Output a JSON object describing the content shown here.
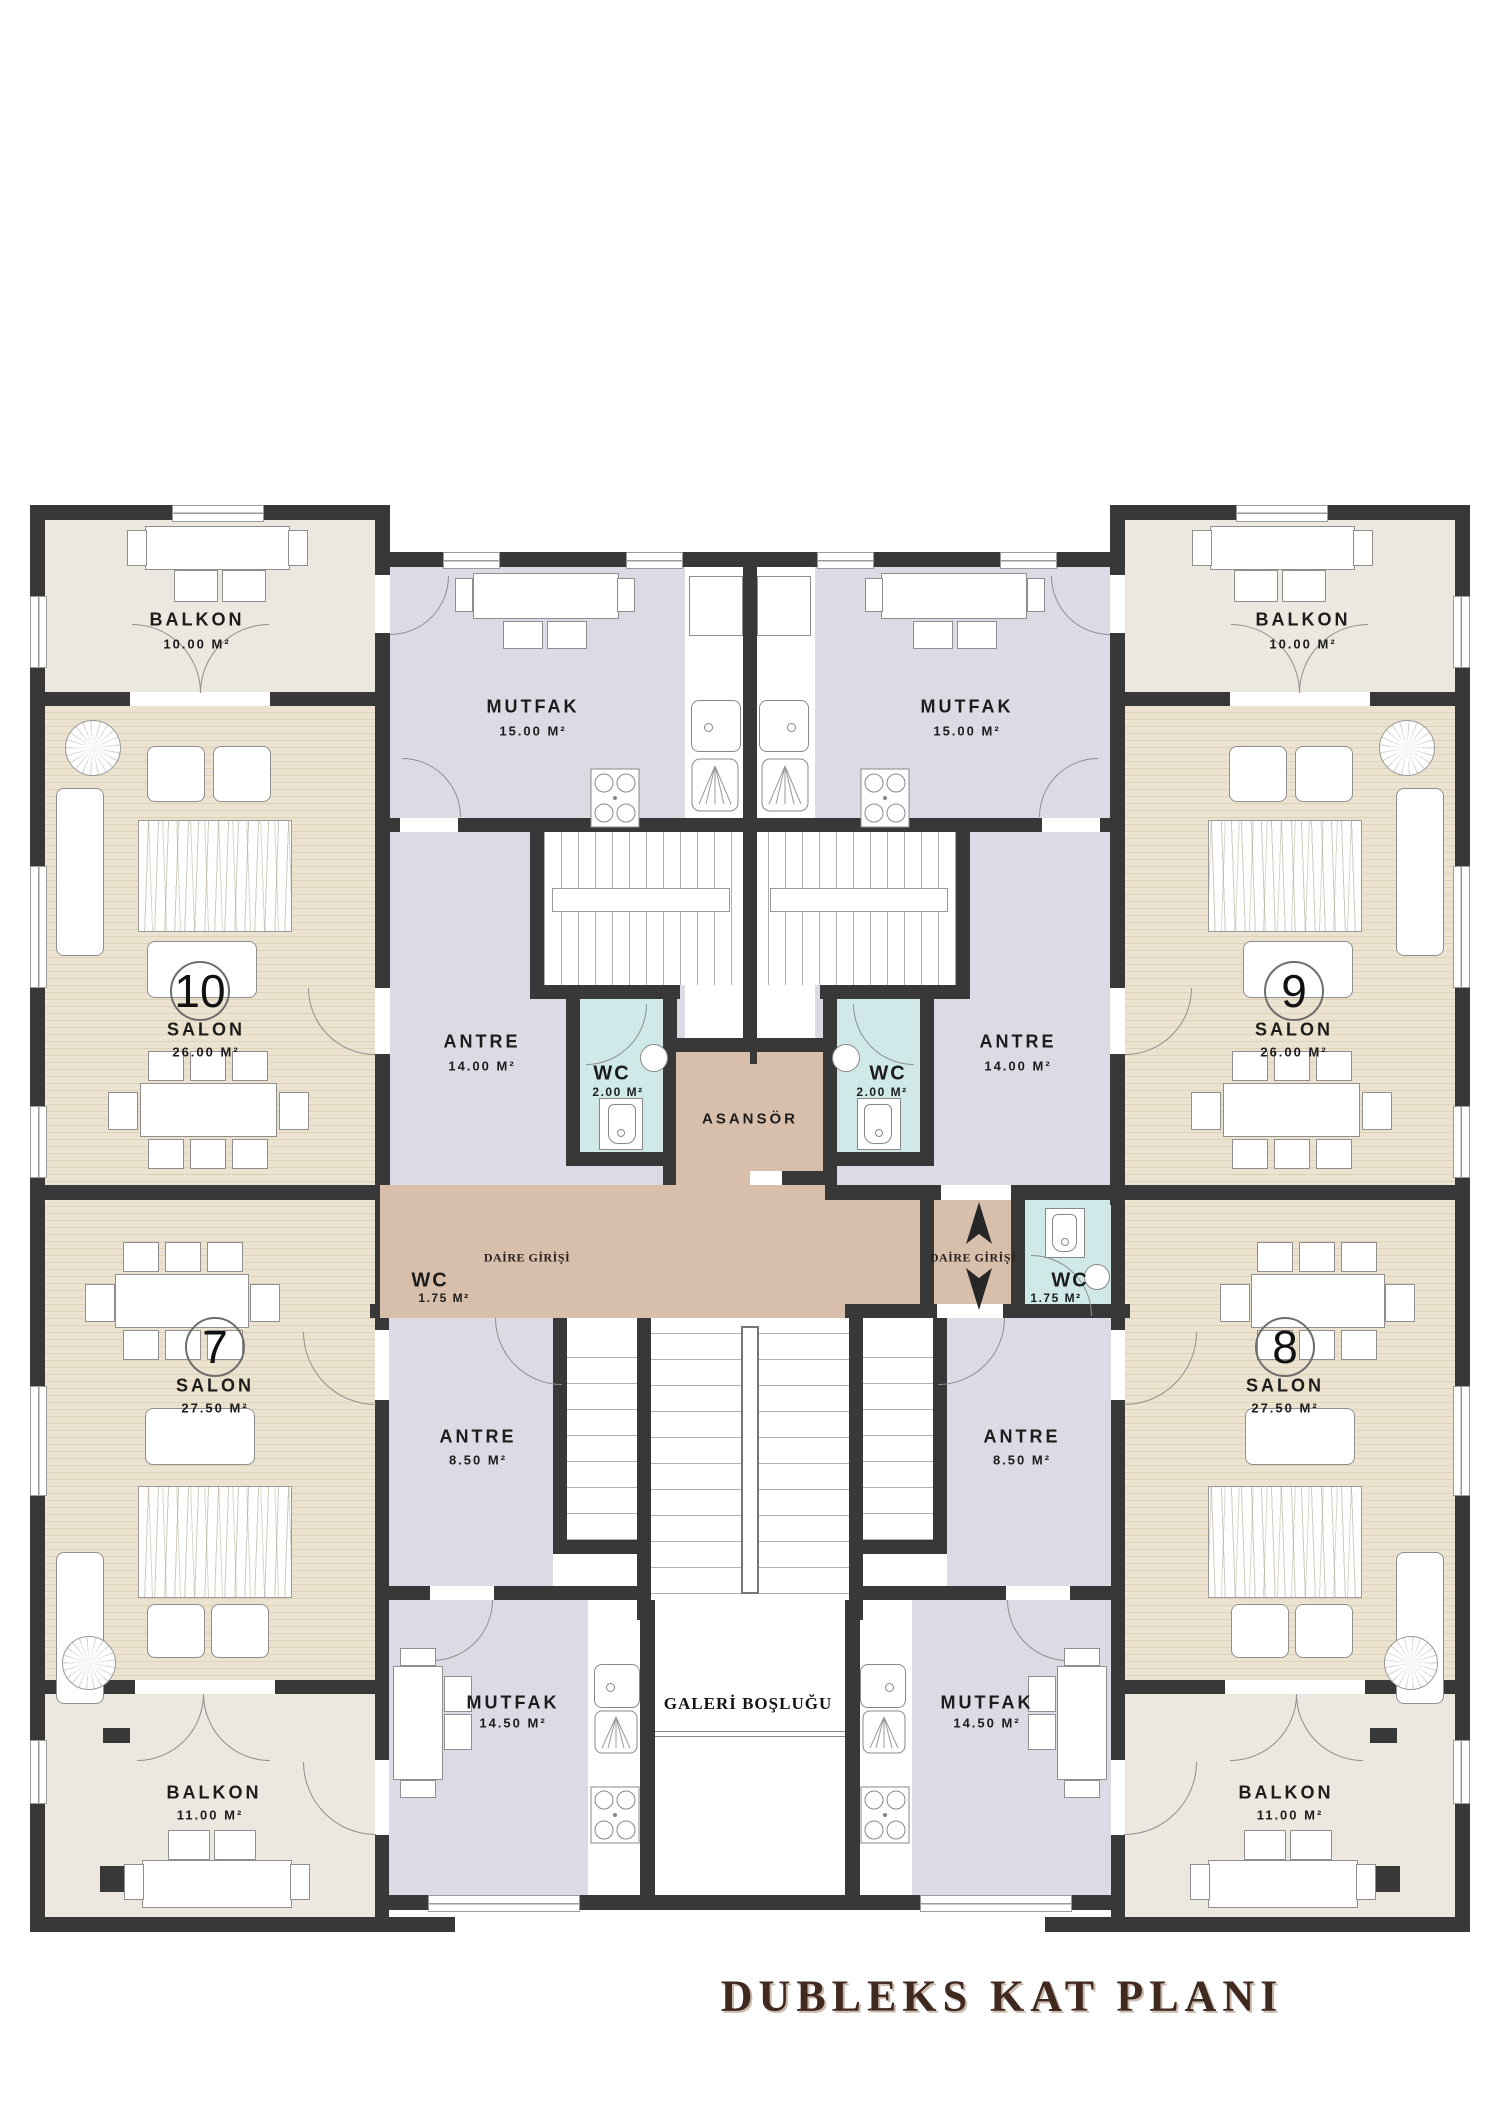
{
  "title": "DUBLEKS KAT PLANI",
  "core": {
    "asansor": "ASANSÖR",
    "daire_girisi": "DAİRE GİRİŞİ",
    "galeri": "GALERİ BOŞLUĞU"
  },
  "apartments": {
    "a10": {
      "number": "10",
      "salon": "SALON",
      "salon_area": "26.00 M²",
      "balkon": "BALKON",
      "balkon_area": "10.00 M²",
      "mutfak": "MUTFAK",
      "mutfak_area": "15.00 M²",
      "antre": "ANTRE",
      "antre_area": "14.00 M²",
      "wc": "WC",
      "wc_area": "2.00 M²"
    },
    "a9": {
      "number": "9",
      "salon": "SALON",
      "salon_area": "26.00 M²",
      "balkon": "BALKON",
      "balkon_area": "10.00 M²",
      "mutfak": "MUTFAK",
      "mutfak_area": "15.00 M²",
      "antre": "ANTRE",
      "antre_area": "14.00 M²",
      "wc": "WC",
      "wc_area": "2.00 M²"
    },
    "a7": {
      "number": "7",
      "salon": "SALON",
      "salon_area": "27.50 M²",
      "balkon": "BALKON",
      "balkon_area": "11.00 M²",
      "mutfak": "MUTFAK",
      "mutfak_area": "14.50 M²",
      "antre": "ANTRE",
      "antre_area": "8.50 M²",
      "wc": "WC",
      "wc_area": "1.75 M²"
    },
    "a8": {
      "number": "8",
      "salon": "SALON",
      "salon_area": "27.50 M²",
      "balkon": "BALKON",
      "balkon_area": "11.00 M²",
      "mutfak": "MUTFAK",
      "mutfak_area": "14.50 M²",
      "antre": "ANTRE",
      "antre_area": "8.50 M²",
      "wc": "WC",
      "wc_area": "1.75 M²"
    }
  }
}
